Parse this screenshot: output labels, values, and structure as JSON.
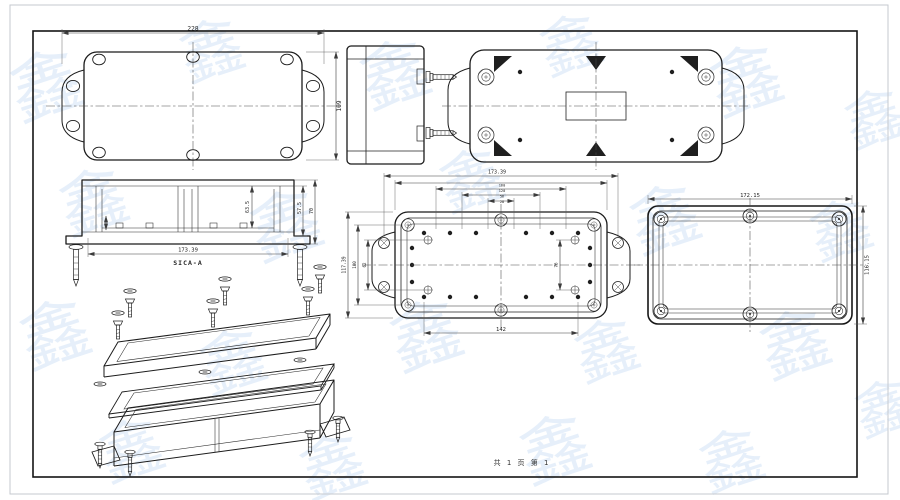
{
  "sheet": {
    "footer": "共 1 页  第 1",
    "watermark_glyph": "鑫",
    "line_color": "#1b1b1b",
    "dim_color": "#3c3c3c",
    "watermark_color": "#d2e3f6"
  },
  "views": {
    "base_top": {
      "dim_width": "228",
      "dim_height": "109"
    },
    "section": {
      "label": "SICA-A",
      "dim_width": "173.39",
      "dim_inner_height": "63.5",
      "dim_mid_height": "57.5",
      "dim_total_height": "70"
    },
    "base_inner": {
      "dim_top": "173.39",
      "dim_bottom": "142",
      "dim_left_outer": "117.39",
      "dim_left_mid": "100",
      "dim_left_inner": "62",
      "dim_right": "76",
      "dim_stack": [
        "160",
        "120",
        "56",
        "28"
      ]
    },
    "lid_inner": {
      "dim_width": "172.15",
      "dim_height": "116.15"
    }
  }
}
